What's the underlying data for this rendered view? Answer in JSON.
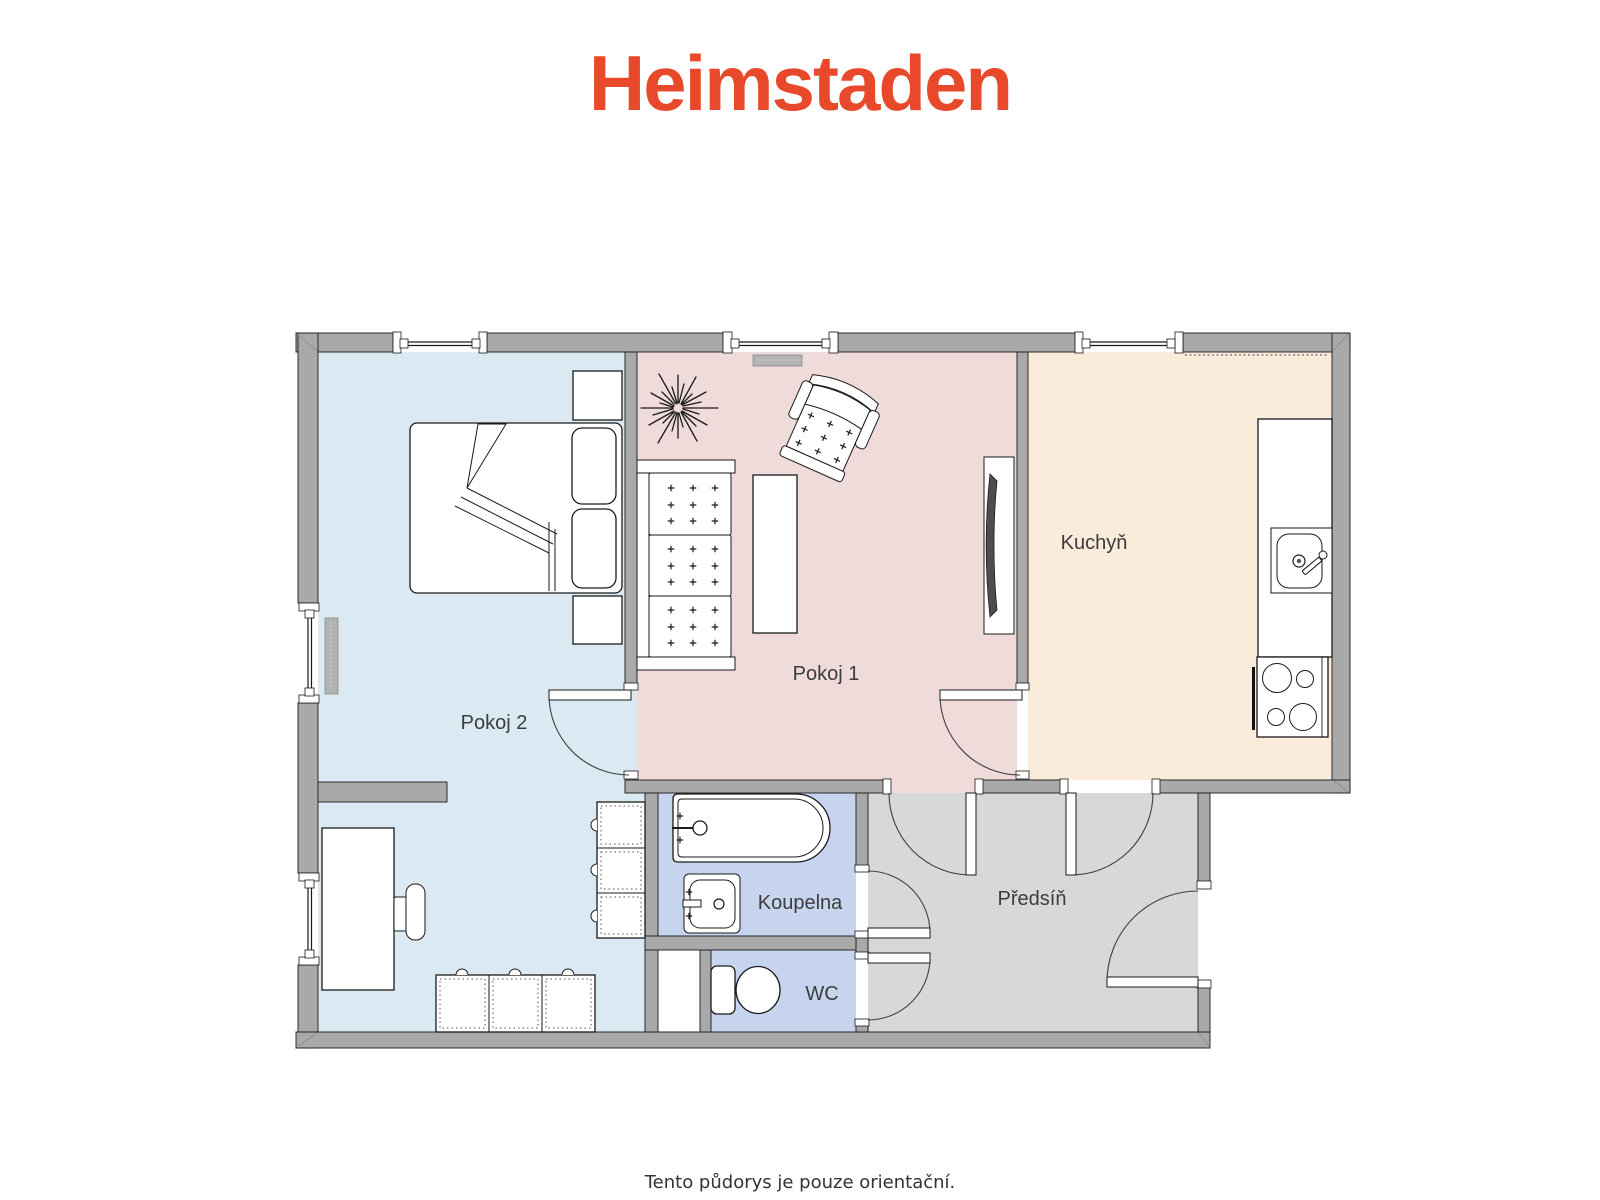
{
  "brand": {
    "logo_text": "Heimstaden",
    "logo_color": "#E8492B"
  },
  "rooms": {
    "pokoj1": {
      "label": "Pokoj 1",
      "floor_color": "#F0DBDB"
    },
    "pokoj2": {
      "label": "Pokoj 2",
      "floor_color": "#DBEAF2"
    },
    "kuchyn": {
      "label": "Kuchyň",
      "floor_color": "#FBEBDB"
    },
    "koupelna": {
      "label": "Koupelna",
      "floor_color": "#C6D4ED"
    },
    "wc": {
      "label": "WC",
      "floor_color": "#C6D4ED"
    },
    "predsin": {
      "label": "Předsíň",
      "floor_color": "#D8D8D8"
    }
  },
  "palette": {
    "wall_fill": "#A9A9A9",
    "outline": "#1A1A1A",
    "door_arc": "#3F3F3F",
    "label_text": "#3C3C3C",
    "shaft_fill": "#FFFFFF"
  },
  "fixtures": [
    "double-bed-icon",
    "pillow-icon",
    "blanket-icon",
    "nightstand-icon",
    "wardrobe-icon",
    "chest-of-drawers-icon",
    "desk-icon",
    "desk-chair-icon",
    "radiator-icon",
    "sofa-icon",
    "armchair-icon",
    "coffee-table-icon",
    "tv-icon",
    "houseplant-icon",
    "kitchen-counter-icon",
    "kitchen-sink-icon",
    "stove-icon",
    "oven-handle-icon",
    "bathtub-icon",
    "washbasin-icon",
    "toilet-icon",
    "door-swing-icon",
    "window-icon",
    "utility-shaft"
  ],
  "footer": {
    "disclaimer": "Tento půdorys je pouze orientační."
  }
}
